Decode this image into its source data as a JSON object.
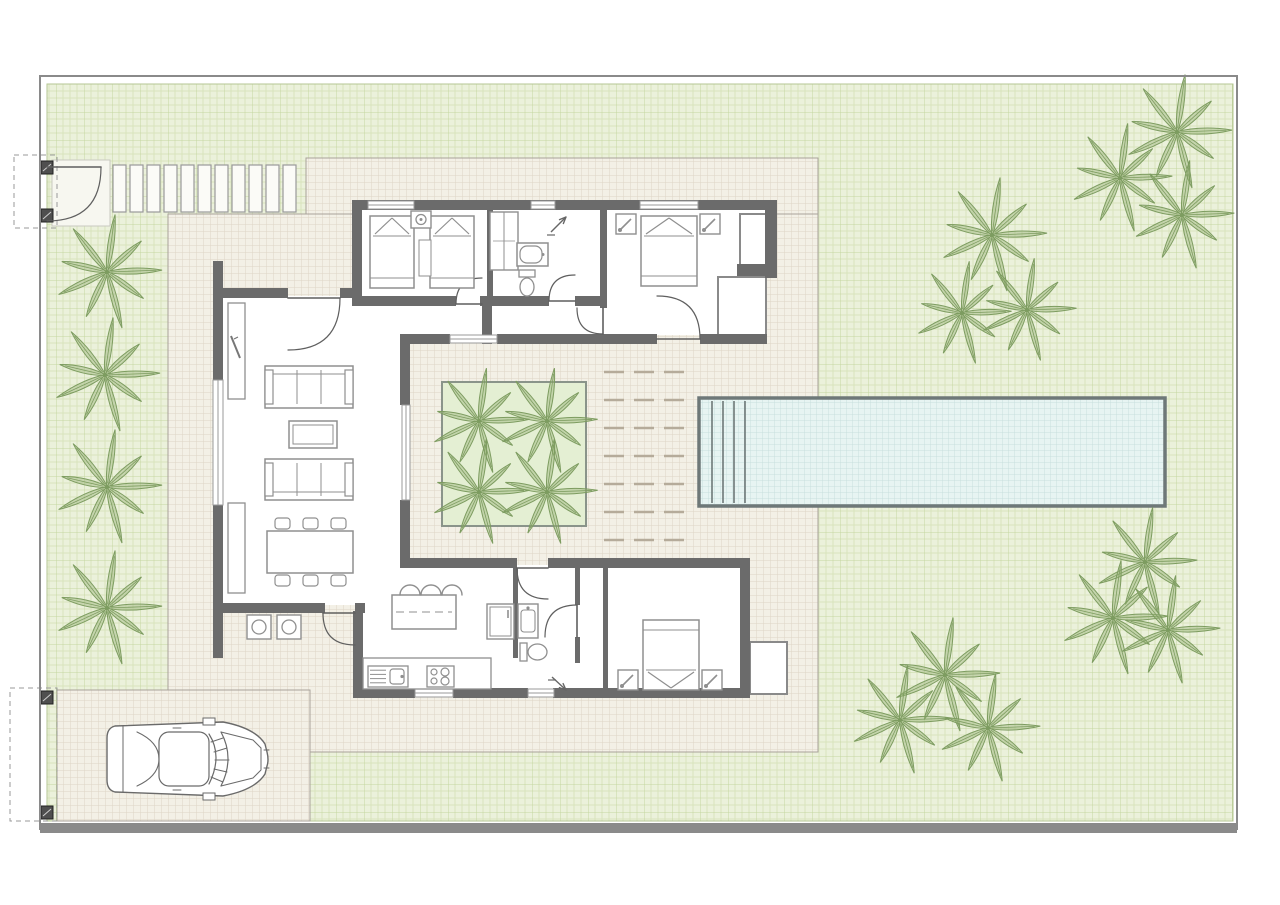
{
  "meta": {
    "description": "villa-site-plan-drawing",
    "canvas": {
      "w": 1280,
      "h": 905
    }
  },
  "colors": {
    "white": "#ffffff",
    "boundary": "#8a8a8a",
    "grass_bg": "#ebf1db",
    "grass_line": "#d8e4bd",
    "grass_line2": "#c4d6a0",
    "grass_edge": "#b5c693",
    "paved_bg": "#f3f0e6",
    "paved_line": "#ded5c5",
    "paved_edge": "#a8a29a",
    "pool_bg": "#e7f4f2",
    "pool_line": "#c9dfdd",
    "pool_border": "#6e7878",
    "wall": "#6b6b6b",
    "partition": "#7a7a7a",
    "bay_line": "#8a8a8a",
    "furn": "#8f8f8f",
    "door": "#5f5f5f",
    "palm_fill": "#9ab377",
    "palm_stroke": "#7d9c60",
    "deck_dash": "#b5ab9a",
    "garden_bed_fill": "#e4efd3",
    "garden_bed_border": "#8a948a",
    "slat_fill": "#fbfbf7",
    "slat_stroke": "#9a9a9a",
    "gate_post": "#4f4f4f",
    "gate_dash": "#9a9a9a",
    "car_line": "#6a6a6a"
  },
  "plot": {
    "boundary_rect": {
      "x": 40,
      "y": 76,
      "w": 1197,
      "h": 753
    },
    "bottom_bar": {
      "x": 40,
      "y": 823,
      "w": 1197,
      "h": 10
    },
    "grass_rect": {
      "x": 47,
      "y": 84,
      "w": 1186,
      "h": 737
    }
  },
  "paved_areas": [
    {
      "name": "terrace-north-strip",
      "x": 306,
      "y": 158,
      "w": 512,
      "h": 56
    },
    {
      "name": "terrace-main",
      "x": 168,
      "y": 214,
      "w": 650,
      "h": 538
    },
    {
      "name": "driveway",
      "x": 57,
      "y": 690,
      "w": 253,
      "h": 131
    }
  ],
  "walkway": {
    "x": 62,
    "y": 165,
    "count": 14,
    "slat_w": 13,
    "slat_h": 47,
    "step": 17
  },
  "gates": [
    {
      "name": "pedestrian-gate",
      "landing": {
        "x": 52,
        "y": 160,
        "w": 58,
        "h": 66
      },
      "dash_rect": {
        "x": 14,
        "y": 155,
        "w": 43,
        "h": 73
      },
      "posts": [
        {
          "x": 41,
          "y": 161,
          "w": 12,
          "h": 13
        },
        {
          "x": 41,
          "y": 209,
          "w": 12,
          "h": 13
        }
      ]
    },
    {
      "name": "driveway-gate",
      "dash_rect": {
        "x": 10,
        "y": 688,
        "w": 47,
        "h": 133
      },
      "posts": [
        {
          "x": 41,
          "y": 691,
          "w": 12,
          "h": 13
        },
        {
          "x": 41,
          "y": 806,
          "w": 12,
          "h": 13
        }
      ]
    }
  ],
  "pool": {
    "x": 699,
    "y": 398,
    "w": 466,
    "h": 108,
    "step_xs": [
      712,
      723,
      734,
      745
    ]
  },
  "courtyard": {
    "garden_bed": {
      "x": 442,
      "y": 382,
      "w": 144,
      "h": 144
    },
    "deck": {
      "x": 596,
      "y": 364,
      "w": 97,
      "h": 180
    }
  },
  "palms": [
    {
      "x": 107,
      "y": 272,
      "s": 1.0
    },
    {
      "x": 105,
      "y": 375,
      "s": 1.0
    },
    {
      "x": 107,
      "y": 487,
      "s": 1.0
    },
    {
      "x": 107,
      "y": 608,
      "s": 1.0
    },
    {
      "x": 1177,
      "y": 132,
      "s": 1.0
    },
    {
      "x": 1120,
      "y": 178,
      "s": 0.95
    },
    {
      "x": 1182,
      "y": 215,
      "s": 0.95
    },
    {
      "x": 992,
      "y": 235,
      "s": 1.0
    },
    {
      "x": 962,
      "y": 313,
      "s": 0.9
    },
    {
      "x": 1027,
      "y": 310,
      "s": 0.9
    },
    {
      "x": 1145,
      "y": 562,
      "s": 0.95
    },
    {
      "x": 1113,
      "y": 618,
      "s": 1.0
    },
    {
      "x": 1168,
      "y": 630,
      "s": 0.95
    },
    {
      "x": 945,
      "y": 675,
      "s": 1.0
    },
    {
      "x": 900,
      "y": 720,
      "s": 0.95
    },
    {
      "x": 988,
      "y": 728,
      "s": 0.95
    },
    {
      "x": 479,
      "y": 421,
      "s": 0.92
    },
    {
      "x": 547,
      "y": 421,
      "s": 0.92
    },
    {
      "x": 479,
      "y": 492,
      "s": 0.92
    },
    {
      "x": 547,
      "y": 492,
      "s": 0.92
    }
  ],
  "house": {
    "floors": [
      {
        "x": 361,
        "y": 209,
        "w": 405,
        "h": 126
      },
      {
        "x": 222,
        "y": 296,
        "w": 181,
        "h": 309
      },
      {
        "x": 352,
        "y": 296,
        "w": 131,
        "h": 40
      },
      {
        "x": 355,
        "y": 565,
        "w": 386,
        "h": 125
      }
    ],
    "walls": [
      {
        "x": 352,
        "y": 200,
        "w": 425,
        "h": 10
      },
      {
        "x": 352,
        "y": 200,
        "w": 10,
        "h": 106
      },
      {
        "x": 765,
        "y": 200,
        "w": 12,
        "h": 78
      },
      {
        "x": 737,
        "y": 264,
        "w": 40,
        "h": 12
      },
      {
        "x": 352,
        "y": 296,
        "w": 104,
        "h": 10
      },
      {
        "x": 480,
        "y": 296,
        "w": 13,
        "h": 10
      },
      {
        "x": 482,
        "y": 296,
        "w": 10,
        "h": 48
      },
      {
        "x": 493,
        "y": 296,
        "w": 56,
        "h": 10
      },
      {
        "x": 575,
        "y": 296,
        "w": 25,
        "h": 10
      },
      {
        "x": 400,
        "y": 334,
        "w": 50,
        "h": 10
      },
      {
        "x": 497,
        "y": 334,
        "w": 160,
        "h": 10
      },
      {
        "x": 700,
        "y": 334,
        "w": 67,
        "h": 10
      },
      {
        "x": 487,
        "y": 210,
        "w": 6,
        "h": 86
      },
      {
        "x": 600,
        "y": 210,
        "w": 7,
        "h": 98
      },
      {
        "x": 213,
        "y": 261,
        "w": 10,
        "h": 119
      },
      {
        "x": 213,
        "y": 505,
        "w": 10,
        "h": 153
      },
      {
        "x": 213,
        "y": 288,
        "w": 75,
        "h": 10
      },
      {
        "x": 340,
        "y": 288,
        "w": 14,
        "h": 10
      },
      {
        "x": 400,
        "y": 343,
        "w": 10,
        "h": 62
      },
      {
        "x": 400,
        "y": 500,
        "w": 10,
        "h": 63
      },
      {
        "x": 222,
        "y": 603,
        "w": 103,
        "h": 10
      },
      {
        "x": 355,
        "y": 603,
        "w": 10,
        "h": 10
      },
      {
        "x": 353,
        "y": 611,
        "w": 10,
        "h": 79
      },
      {
        "x": 400,
        "y": 558,
        "w": 117,
        "h": 10
      },
      {
        "x": 548,
        "y": 558,
        "w": 202,
        "h": 10
      },
      {
        "x": 513,
        "y": 568,
        "w": 5,
        "h": 90
      },
      {
        "x": 575,
        "y": 568,
        "w": 5,
        "h": 37
      },
      {
        "x": 575,
        "y": 637,
        "w": 5,
        "h": 26
      },
      {
        "x": 603,
        "y": 568,
        "w": 5,
        "h": 120
      },
      {
        "x": 740,
        "y": 558,
        "w": 10,
        "h": 140
      },
      {
        "x": 353,
        "y": 688,
        "w": 62,
        "h": 10
      },
      {
        "x": 453,
        "y": 688,
        "w": 75,
        "h": 10
      },
      {
        "x": 553,
        "y": 688,
        "w": 197,
        "h": 10
      }
    ],
    "bays": [
      {
        "name": "glass-bay-north",
        "x": 718,
        "y": 277,
        "w": 48,
        "h": 66
      },
      {
        "name": "corner-nook",
        "x": 740,
        "y": 214,
        "w": 26,
        "h": 54
      },
      {
        "name": "glass-bay-south",
        "x": 750,
        "y": 642,
        "w": 37,
        "h": 52
      }
    ],
    "windows": [
      {
        "x": 368,
        "y": 201,
        "w": 46,
        "h": 8
      },
      {
        "x": 531,
        "y": 201,
        "w": 24,
        "h": 8
      },
      {
        "x": 640,
        "y": 201,
        "w": 58,
        "h": 8
      },
      {
        "x": 213,
        "y": 380,
        "w": 10,
        "h": 125
      },
      {
        "x": 402,
        "y": 405,
        "w": 8,
        "h": 95
      },
      {
        "x": 450,
        "y": 335,
        "w": 47,
        "h": 8
      },
      {
        "x": 415,
        "y": 689,
        "w": 38,
        "h": 8
      },
      {
        "x": 528,
        "y": 689,
        "w": 26,
        "h": 8
      }
    ],
    "doors": [
      {
        "name": "entry-door",
        "h": [
          288,
          298
        ],
        "s": [
          340,
          298
        ],
        "e": [
          288,
          350
        ]
      },
      {
        "name": "twin-room-door",
        "h": [
          482,
          304
        ],
        "s": [
          456,
          304
        ],
        "e": [
          482,
          278
        ]
      },
      {
        "name": "bath1-door",
        "h": [
          575,
          301
        ],
        "s": [
          549,
          301
        ],
        "e": [
          575,
          275
        ]
      },
      {
        "name": "master-door",
        "h": [
          603,
          308
        ],
        "s": [
          603,
          334
        ],
        "e": [
          577,
          308
        ]
      },
      {
        "name": "patio-door-north",
        "h": [
          657,
          339
        ],
        "s": [
          700,
          339
        ],
        "e": [
          657,
          296
        ]
      },
      {
        "name": "kitchen-door",
        "h": [
          355,
          613
        ],
        "s": [
          323,
          613
        ],
        "e": [
          355,
          645
        ]
      },
      {
        "name": "patio-door-south",
        "h": [
          548,
          568
        ],
        "s": [
          517,
          568
        ],
        "e": [
          548,
          599
        ]
      },
      {
        "name": "bath2-door",
        "h": [
          577,
          637
        ],
        "s": [
          577,
          605
        ],
        "e": [
          545,
          637
        ]
      },
      {
        "name": "gate-door",
        "h": [
          47,
          167
        ],
        "s": [
          101,
          167
        ],
        "e": [
          47,
          221
        ]
      }
    ]
  },
  "furniture": [
    {
      "type": "bed",
      "name": "bed-twin-a",
      "x": 370,
      "y": 216,
      "w": 44,
      "h": 72,
      "head": "top"
    },
    {
      "type": "bed",
      "name": "bed-twin-b",
      "x": 430,
      "y": 216,
      "w": 44,
      "h": 72,
      "head": "top"
    },
    {
      "type": "rug",
      "name": "runner-rug",
      "x": 419,
      "y": 240,
      "w": 12,
      "h": 36
    },
    {
      "type": "nightstand",
      "name": "nightstand-twin",
      "x": 411,
      "y": 211,
      "w": 20,
      "h": 17,
      "lamp": "circle"
    },
    {
      "type": "closet",
      "name": "wardrobe",
      "x": 490,
      "y": 212,
      "w": 28,
      "h": 58
    },
    {
      "type": "tub",
      "name": "bathtub",
      "x": 517,
      "y": 243,
      "w": 31,
      "h": 23
    },
    {
      "type": "toilet",
      "name": "toilet-1",
      "x": 519,
      "y": 270,
      "w": 16,
      "h": 27,
      "orient": "v"
    },
    {
      "type": "arrow",
      "name": "shower-drain-arrow-1",
      "x1": 551,
      "y1": 232,
      "x2": 566,
      "y2": 217
    },
    {
      "type": "bed",
      "name": "bed-master",
      "x": 641,
      "y": 216,
      "w": 56,
      "h": 70,
      "head": "top"
    },
    {
      "type": "nightstand",
      "name": "nightstand-master-l",
      "x": 616,
      "y": 214,
      "w": 20,
      "h": 20,
      "lamp": "diag"
    },
    {
      "type": "nightstand",
      "name": "nightstand-master-r",
      "x": 700,
      "y": 214,
      "w": 20,
      "h": 20,
      "lamp": "diag"
    },
    {
      "type": "sideboard",
      "name": "tv-sideboard",
      "x": 228,
      "y": 303,
      "w": 17,
      "h": 96
    },
    {
      "type": "tv",
      "name": "tv-mark",
      "x": 231,
      "y": 336
    },
    {
      "type": "sideboard",
      "name": "sideboard-2",
      "x": 228,
      "y": 503,
      "w": 17,
      "h": 90
    },
    {
      "type": "sofa",
      "name": "sofa-1",
      "x": 265,
      "y": 366,
      "w": 88,
      "h": 42,
      "back": "top"
    },
    {
      "type": "ctable",
      "name": "coffee-table",
      "x": 289,
      "y": 421,
      "w": 48,
      "h": 27
    },
    {
      "type": "sofa",
      "name": "sofa-2",
      "x": 265,
      "y": 459,
      "w": 88,
      "h": 41,
      "back": "bottom"
    },
    {
      "type": "dining",
      "name": "dining-table",
      "x": 267,
      "y": 531,
      "w": 86,
      "h": 42
    },
    {
      "type": "washer",
      "name": "outdoor-unit-a",
      "x": 247,
      "y": 615,
      "w": 24,
      "h": 24
    },
    {
      "type": "washer",
      "name": "outdoor-unit-b",
      "x": 277,
      "y": 615,
      "w": 24,
      "h": 24
    },
    {
      "type": "island",
      "name": "kitchen-island",
      "x": 392,
      "y": 595,
      "w": 64,
      "h": 34
    },
    {
      "type": "stools",
      "name": "bar-stools",
      "x": 400,
      "y": 595,
      "n": 3,
      "r": 10,
      "gap": 21
    },
    {
      "type": "counter",
      "name": "kitchen-counter",
      "x": 363,
      "y": 658,
      "w": 128,
      "h": 31
    },
    {
      "type": "sink_unit",
      "name": "kitchen-sink",
      "x": 368,
      "y": 666,
      "w": 40,
      "h": 21
    },
    {
      "type": "cooktop",
      "name": "cooktop",
      "x": 427,
      "y": 666,
      "w": 27,
      "h": 21
    },
    {
      "type": "tall_unit",
      "name": "fridge",
      "x": 487,
      "y": 604,
      "w": 27,
      "h": 35
    },
    {
      "type": "sink",
      "name": "bath2-sink",
      "x": 518,
      "y": 604,
      "w": 20,
      "h": 34
    },
    {
      "type": "toilet",
      "name": "toilet-2",
      "x": 520,
      "y": 643,
      "w": 28,
      "h": 18,
      "orient": "h"
    },
    {
      "type": "arrow",
      "name": "shower-drain-arrow-2",
      "x1": 552,
      "y1": 677,
      "x2": 566,
      "y2": 690
    },
    {
      "type": "bed",
      "name": "bed-guest",
      "x": 643,
      "y": 620,
      "w": 56,
      "h": 70,
      "head": "bottom"
    },
    {
      "type": "nightstand",
      "name": "nightstand-guest-l",
      "x": 618,
      "y": 670,
      "w": 20,
      "h": 20,
      "lamp": "diag"
    },
    {
      "type": "nightstand",
      "name": "nightstand-guest-r",
      "x": 702,
      "y": 670,
      "w": 20,
      "h": 20,
      "lamp": "diag"
    }
  ],
  "car": {
    "x": 103,
    "y": 720,
    "w": 168,
    "h": 78
  }
}
